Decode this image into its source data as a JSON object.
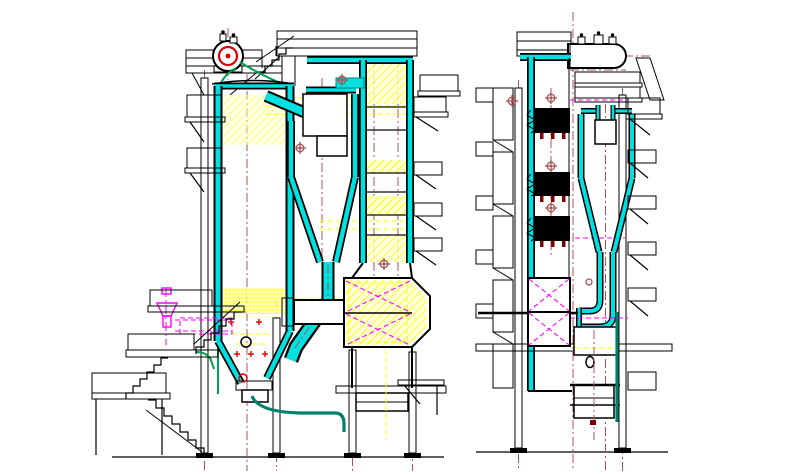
{
  "document": {
    "kind": "engineering-cad-drawing",
    "subject": "circulating-fluidized-bed-boiler-general-arrangement",
    "visible_text": [],
    "views": [
      {
        "id": "side-elevation",
        "components": [
          "steam-drum",
          "furnace",
          "cyclone-separator",
          "loop-seal-return-leg",
          "backpass-tube-banks",
          "air-heater",
          "coal-feeder",
          "access-platforms",
          "stairs",
          "support-columns",
          "ground-line"
        ]
      },
      {
        "id": "end-elevation",
        "components": [
          "steam-drum",
          "furnace-tube-banks",
          "cyclone-separator",
          "loop-seal",
          "ladder-tower",
          "access-platforms",
          "cross-bracing",
          "support-columns",
          "ground-line"
        ]
      }
    ]
  },
  "colors": {
    "bg": "#FFFFFF",
    "line": "#000000",
    "cyan": "#00E0E0",
    "teal": "#007F7F",
    "red": "#DD0000",
    "redDark": "#7E0000",
    "yellow": "#FFFF00",
    "cream": "#FFFFD4",
    "green": "#00A050",
    "ashteal": "#00806A",
    "maroon": "#A85454",
    "magenta": "#FF00FF"
  }
}
